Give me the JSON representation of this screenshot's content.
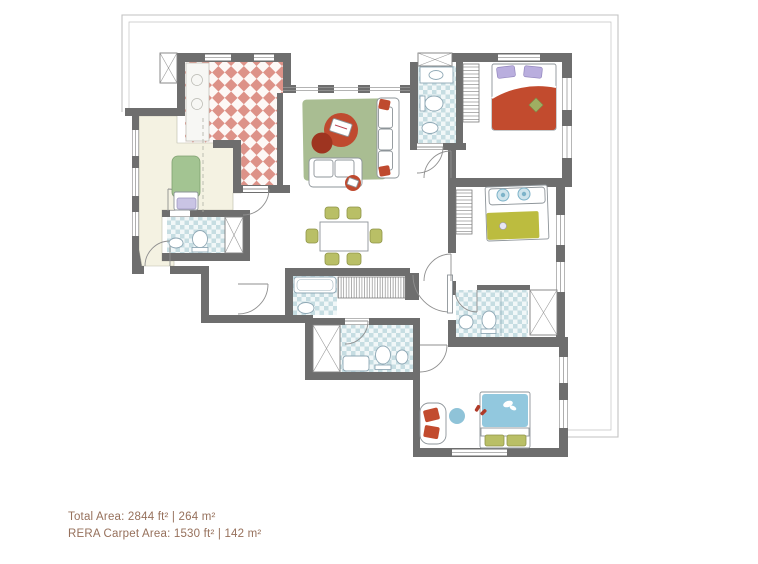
{
  "footer": {
    "line1": "Total Area: 2844 ft² | 264 m²",
    "line2": "RERA Carpet Area: 1530 ft² | 142 m²"
  },
  "colors": {
    "wall": "#6e6e6e",
    "terrace_line": "#c2c2c2",
    "checker_red": "#dd9288",
    "tile_blue": "#c6dde2",
    "tile_bg": "#f1f7f8",
    "cream": "#f4f2e2",
    "rug_green": "#a9bd92",
    "table_red": "#bf4a2f",
    "table_red_dark": "#9e3420",
    "chair_olive": "#b9bf66",
    "bed_red": "#c24b2e",
    "bed_olive": "#bcbc3f",
    "bed_blue": "#92c8de",
    "bed_green": "#a3c492",
    "pillow_purple": "#b9aede",
    "pillow_blue": "#7db3c9",
    "fixture": "#8fa8b5",
    "accent_text": "#96705b"
  }
}
